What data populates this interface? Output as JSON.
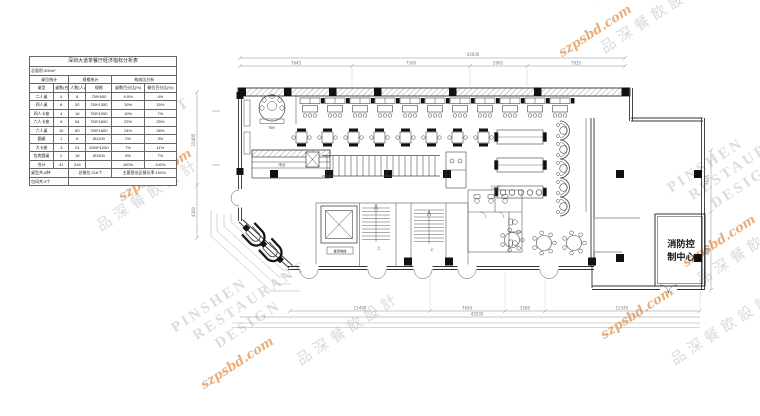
{
  "watermark": {
    "line1": "PINSHEN",
    "line2": "RESTAURANT",
    "line3": "DESIGN",
    "url": "szpsbd.com",
    "cjk": "品深餐飲設計"
  },
  "seating_table": {
    "title": "深圳大道茶餐厅经济指标分析表",
    "sub1": "总面积:300m²",
    "sub2": [
      "桌位统计",
      "规格统计",
      "构成比分析"
    ],
    "headers": [
      "桌型",
      "桌数(台)",
      "人数(人)",
      "规格",
      "桌数百分比(%)",
      "餐位百分比(%)"
    ],
    "rows": [
      [
        "二人桌",
        "4",
        "8",
        "750*600",
        "9.5%",
        "4%"
      ],
      [
        "四人桌",
        "8",
        "32",
        "750*1350",
        "19%",
        "15%"
      ],
      [
        "四人卡座",
        "4",
        "16",
        "750*1200",
        "10%",
        "7%"
      ],
      [
        "六人卡座",
        "9",
        "54",
        "750*1600",
        "22%",
        "25%"
      ],
      [
        "六人桌",
        "10",
        "60",
        "750*1600",
        "24%",
        "28%"
      ],
      [
        "圆桌",
        "1",
        "6",
        "Ø1200",
        "2%",
        "3%"
      ],
      [
        "大卡座",
        "3",
        "24",
        "5200*1200",
        "7%",
        "11%"
      ],
      [
        "包房圆桌",
        "2",
        "16",
        "Ø1500",
        "5%",
        "7%"
      ],
      [
        "合计",
        "41",
        "216",
        "",
        "100%",
        "100%"
      ]
    ],
    "footer1": [
      "桌型共:8种",
      "总餐位:216个",
      "主要营业区餐位率:100%"
    ],
    "footer2": [
      "包间共:3个",
      ""
    ]
  },
  "plan": {
    "dims": {
      "top_total": "43030",
      "top_segments": [
        "7645",
        "7500",
        "2995",
        "7935"
      ],
      "bottom_segments": [
        "13490",
        "7650",
        "3560",
        "12345"
      ],
      "bottom_total": "43030",
      "left_upper": "15495",
      "left_lower": "4300",
      "right_upper": "7635",
      "right_lower": "4635",
      "win_a": "4300",
      "win_b": "4300"
    },
    "labels": {
      "fire_line1": "消防控",
      "fire_line2": "制中心",
      "elevator": "客用电梯",
      "stair_up": "上",
      "reception": "前台",
      "bar": "吧台",
      "wc": "卫生间"
    }
  }
}
